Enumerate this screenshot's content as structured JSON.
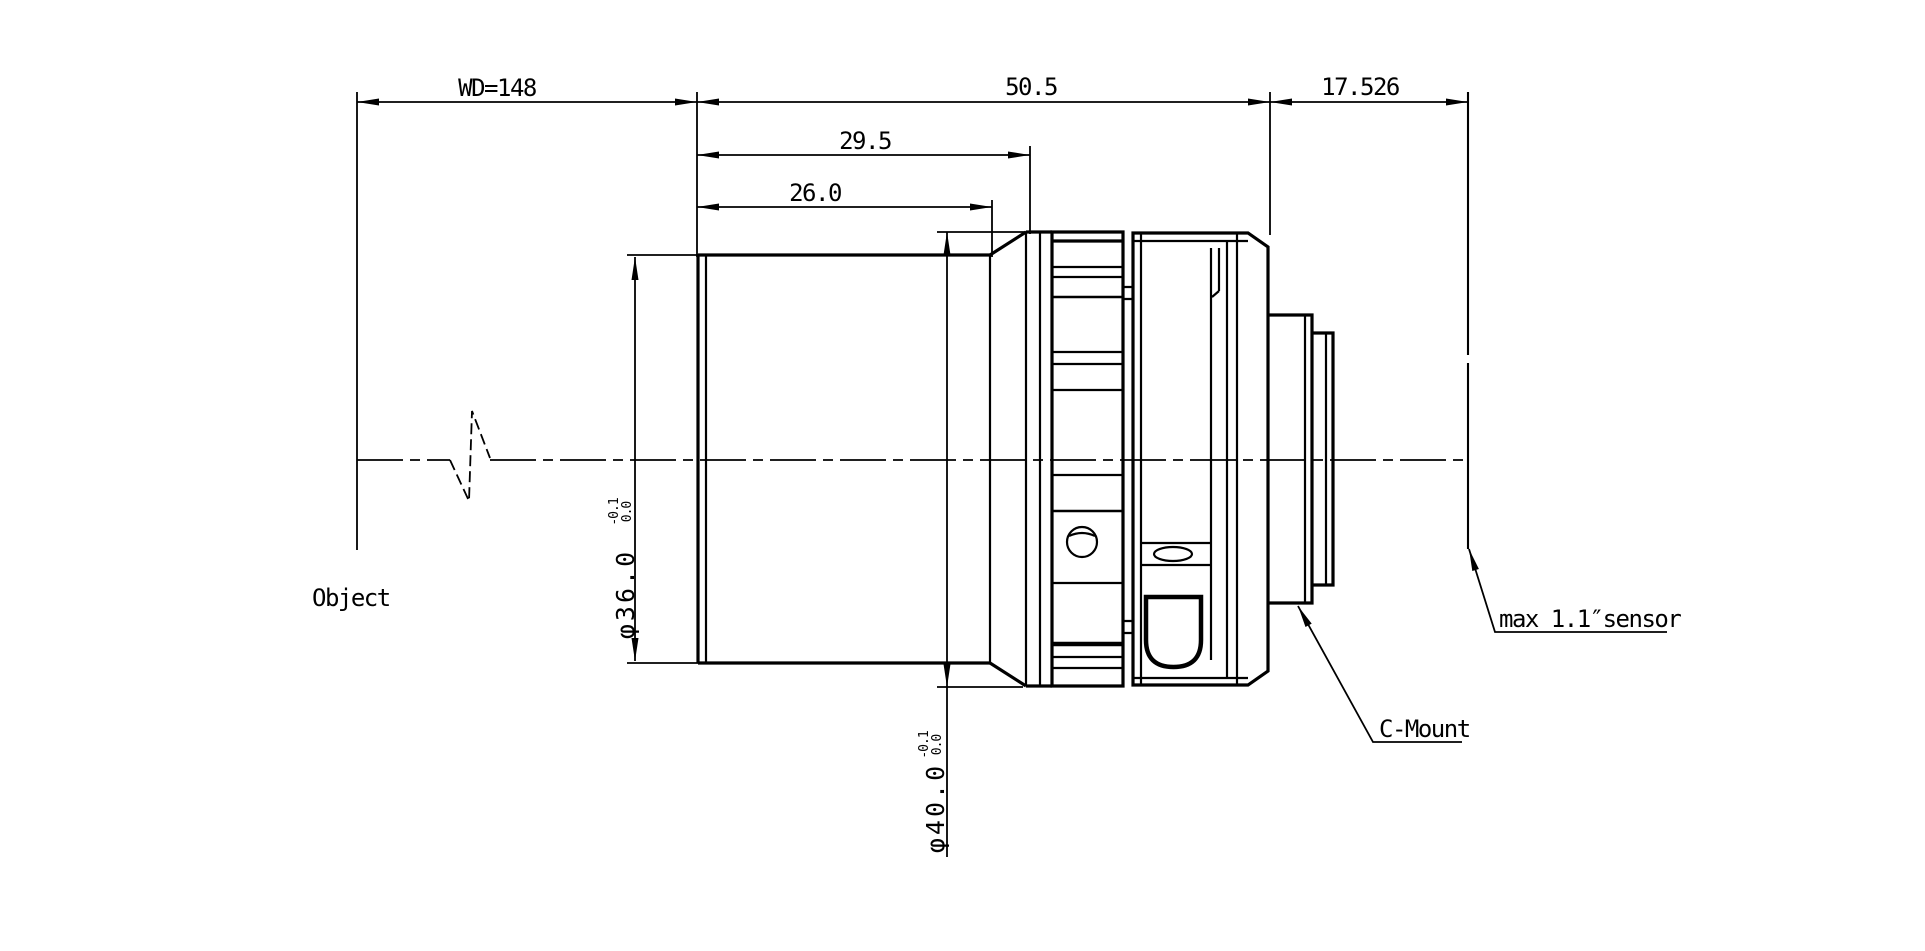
{
  "drawing": {
    "background": "#ffffff",
    "line_color": "#000000",
    "labels": {
      "object": "Object",
      "c_mount": "C-Mount",
      "sensor": "max 1.1″sensor"
    },
    "dims": {
      "wd": "WD=148",
      "total_length": "50.5",
      "flange_distance": "17.526",
      "front_length": "29.5",
      "front_barrel_length": "26.0",
      "dia36": {
        "value": "φ36.0",
        "tol_upper": "0.0",
        "tol_lower": "-0.1"
      },
      "dia40": {
        "value": "φ40.0",
        "tol_upper": "0.0",
        "tol_lower": "-0.1"
      }
    }
  }
}
